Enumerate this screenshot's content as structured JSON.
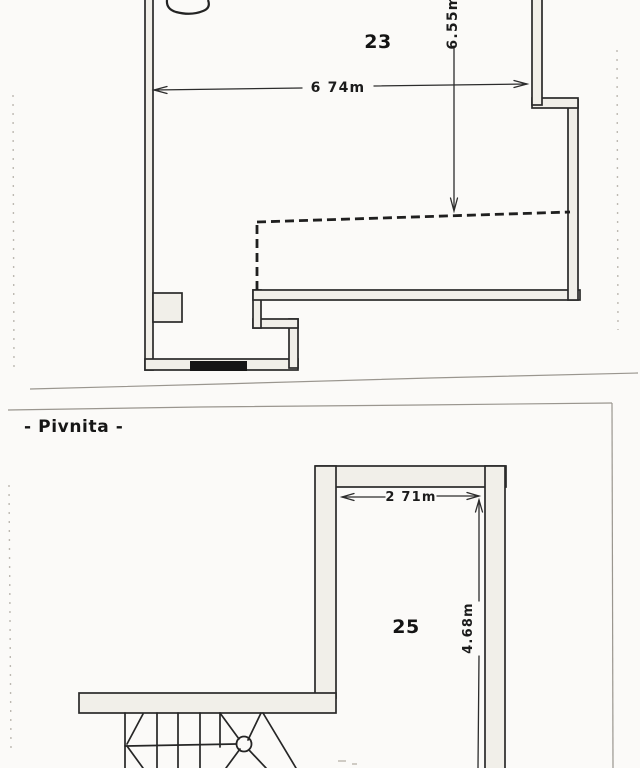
{
  "floorplan": {
    "upper_plan": {
      "room_number": "23",
      "width_dimension": "6 74m",
      "depth_dimension": "6.55m"
    },
    "lower_plan": {
      "section_title": "- Pivnita -",
      "room_number": "25",
      "width_dimension": "2 71m",
      "depth_dimension": "4.68m"
    },
    "colors": {
      "ink": "#262626",
      "wall_fill": "#f1efe9",
      "paper": "#fbfaf8",
      "page_border": "#9a968f",
      "threshold_fill": "#151515"
    }
  }
}
